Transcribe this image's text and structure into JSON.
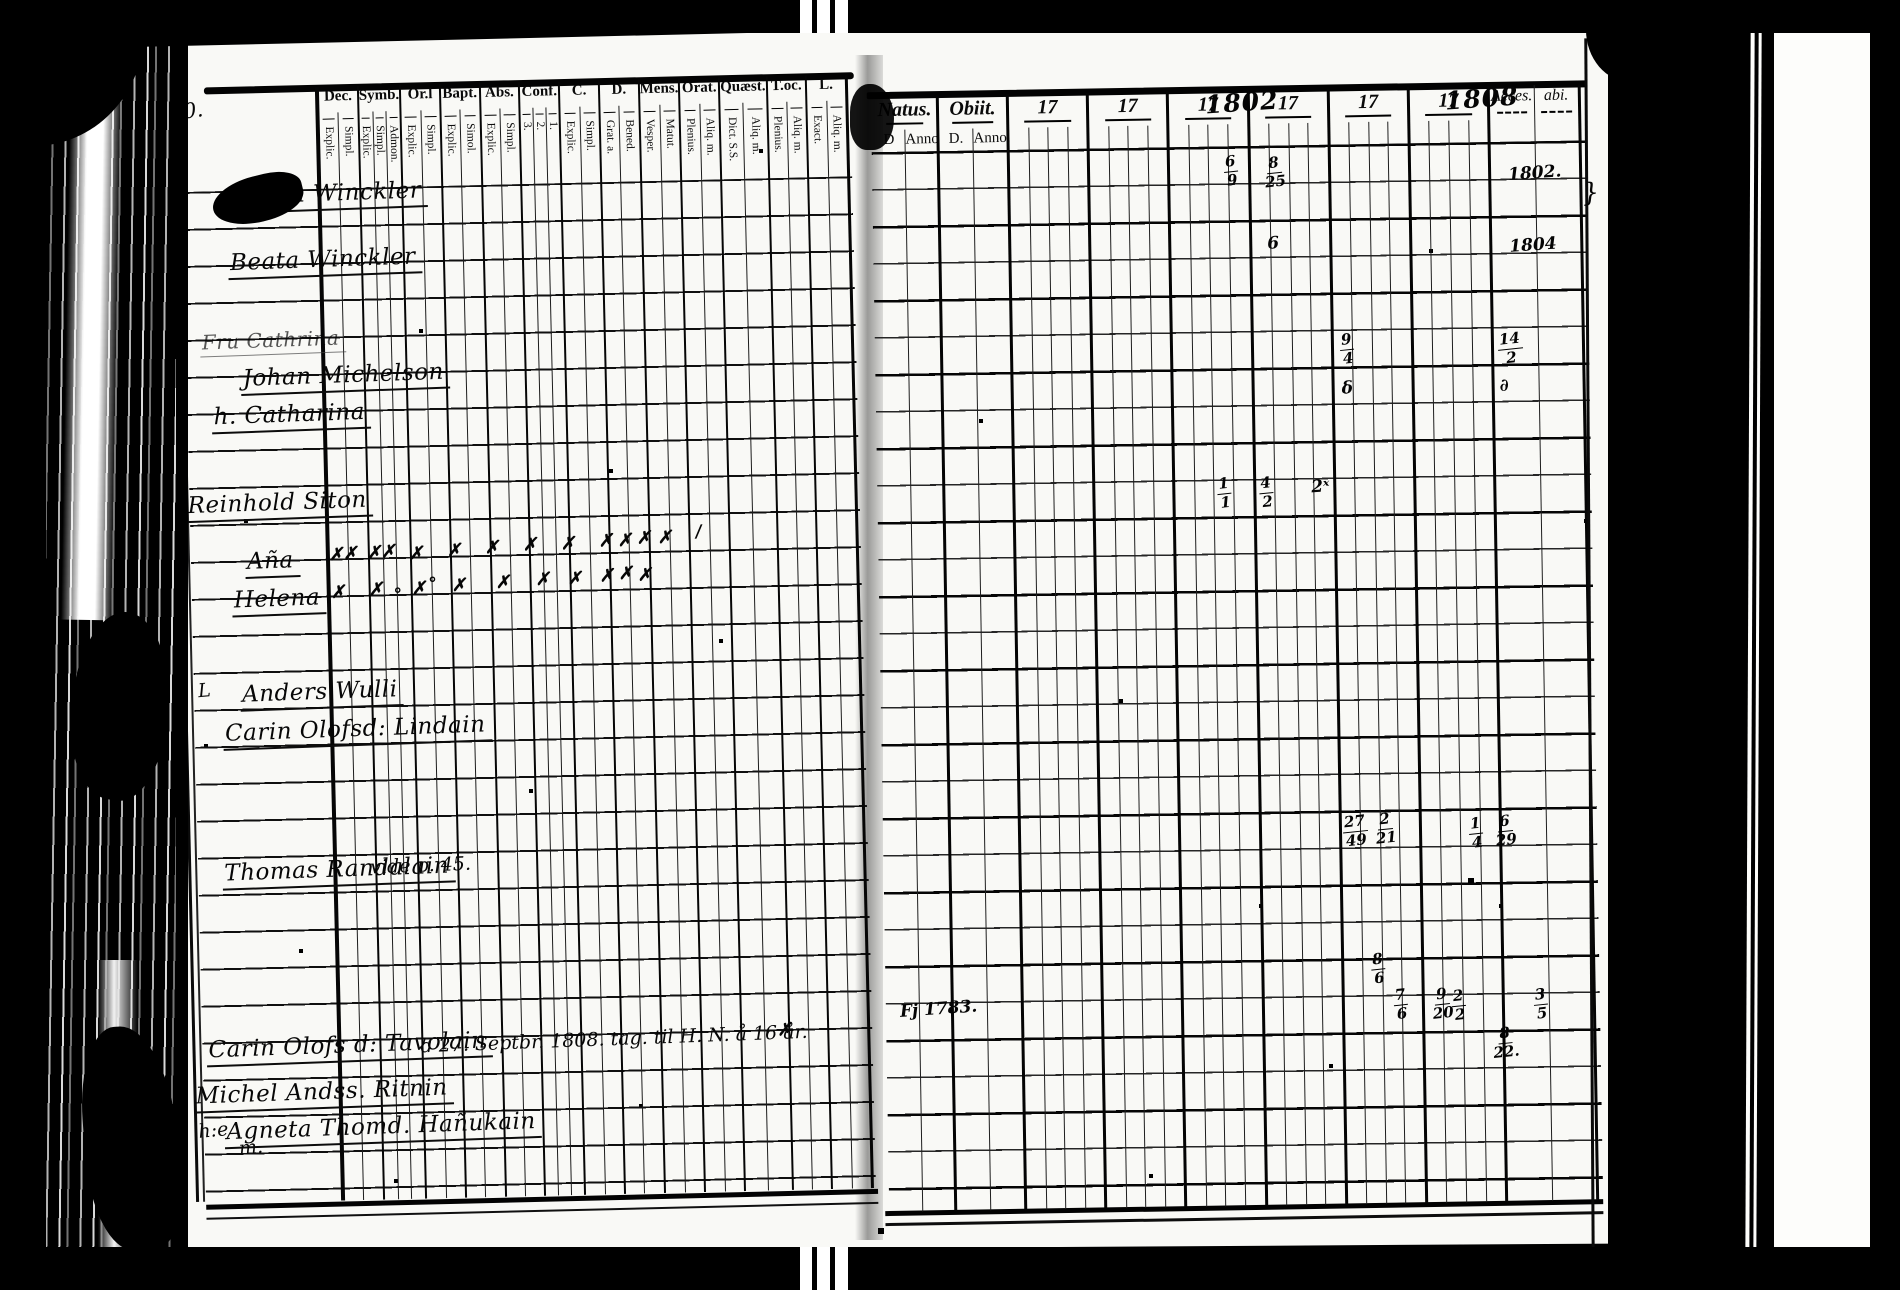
{
  "document": {
    "kind": "scanned parish examination register, two-page spread",
    "left_page_number": "210.",
    "ink_color": "#0a0a0a",
    "paper_color": "#f9f9f6"
  },
  "left_table": {
    "columns": [
      {
        "label": "Dec.",
        "subs": [
          "Explic.",
          "Simpl."
        ]
      },
      {
        "label": "Symb.",
        "subs": [
          "Explic.",
          "Simpl.",
          "Admon."
        ]
      },
      {
        "label": "Or.l",
        "subs": [
          "Explic.",
          "Simpl."
        ]
      },
      {
        "label": "Bapt.",
        "subs": [
          "Explic.",
          "Simol."
        ]
      },
      {
        "label": "Abs.",
        "subs": [
          "Explic.",
          "Simpl."
        ]
      },
      {
        "label": "Conf.",
        "subs": [
          "3.",
          "2.",
          "1."
        ]
      },
      {
        "label": "C.",
        "subs": [
          "Explic.",
          "Simpl."
        ]
      },
      {
        "label": "D.",
        "subs": [
          "Grat. a.",
          "Bened."
        ]
      },
      {
        "label": "Mens.",
        "subs": [
          "Vesper.",
          "Matut."
        ]
      },
      {
        "label": "Orat.",
        "subs": [
          "Plenius.",
          "Aliq. m."
        ]
      },
      {
        "label": "Quæst.",
        "subs": [
          "Dict. S.S.",
          "Aliq. m."
        ]
      },
      {
        "label": "T.oc.",
        "subs": [
          "Plenius.",
          "Aliq. m."
        ]
      },
      {
        "label": "L.",
        "subs": [
          "Exact.",
          "Aliq. m."
        ]
      }
    ],
    "names": [
      {
        "x": 62,
        "y": 140,
        "t": "Johan Winckler"
      },
      {
        "x": 54,
        "y": 206,
        "t": "Beata Winckler"
      },
      {
        "x": 24,
        "y": 286,
        "t": "Fru Cathrina",
        "c": "faint"
      },
      {
        "x": 64,
        "y": 322,
        "t": "Johan Michelson"
      },
      {
        "x": 34,
        "y": 360,
        "t": "h. Catharina"
      },
      {
        "x": 6,
        "y": 448,
        "t": "Reinhold Siton"
      },
      {
        "x": 64,
        "y": 506,
        "t": "Aña"
      },
      {
        "x": 50,
        "y": 544,
        "t": "Helena"
      },
      {
        "x": 56,
        "y": 638,
        "t": "Anders Wulli"
      },
      {
        "x": 38,
        "y": 676,
        "t": "Carin Olofsd: Lindain"
      },
      {
        "x": 34,
        "y": 816,
        "t": "Thomas Randalain"
      },
      {
        "x": 14,
        "y": 992,
        "t": "Carin Olofs d: Tavolain"
      },
      {
        "x": 0,
        "y": 1038,
        "t": "Michel Andss. Ritnin"
      },
      {
        "x": 30,
        "y": 1074,
        "t": "Agneta Thomd. Hañukain"
      }
    ],
    "annotations": [
      {
        "x": -14,
        "y": 56,
        "t": "210.",
        "c": "pagenum"
      },
      {
        "x": -44,
        "y": 212,
        "t": "D:24",
        "c": "pref"
      },
      {
        "x": -26,
        "y": 290,
        "t": "h.",
        "c": "pref"
      },
      {
        "x": -28,
        "y": 450,
        "t": "B:f",
        "c": "pref"
      },
      {
        "x": 14,
        "y": 636,
        "t": "L",
        "c": "pref"
      },
      {
        "x": -48,
        "y": 1040,
        "t": "Gml",
        "c": "pref"
      },
      {
        "x": 4,
        "y": 1076,
        "t": "h:e",
        "c": "pref"
      },
      {
        "x": 182,
        "y": 816,
        "t": "vide p. 45.",
        "c": "note"
      },
      {
        "x": 228,
        "y": 994,
        "t": "d 27. Septbr. 1808. tag. til H. N. å 16 år.",
        "c": "note"
      },
      {
        "x": 44,
        "y": 1094,
        "t": "m.",
        "c": "pref"
      }
    ],
    "attendance_marks": [
      {
        "x": 148,
        "y": 504,
        "t": "✗✗"
      },
      {
        "x": 186,
        "y": 503,
        "t": "✗✗"
      },
      {
        "x": 228,
        "y": 505,
        "t": "✗"
      },
      {
        "x": 266,
        "y": 503,
        "t": "✗"
      },
      {
        "x": 304,
        "y": 501,
        "t": "✗"
      },
      {
        "x": 342,
        "y": 499,
        "t": "✗"
      },
      {
        "x": 380,
        "y": 499,
        "t": "✗"
      },
      {
        "x": 418,
        "y": 497,
        "t": "✗"
      },
      {
        "x": 437,
        "y": 497,
        "t": "✗"
      },
      {
        "x": 456,
        "y": 495,
        "t": "✗"
      },
      {
        "x": 477,
        "y": 495,
        "t": "✗"
      },
      {
        "x": 515,
        "y": 490,
        "t": "∕"
      },
      {
        "x": 149,
        "y": 542,
        "t": "✗"
      },
      {
        "x": 187,
        "y": 540,
        "t": "✗"
      },
      {
        "x": 212,
        "y": 546,
        "t": "°"
      },
      {
        "x": 230,
        "y": 540,
        "t": "✗"
      },
      {
        "x": 247,
        "y": 536,
        "t": "°"
      },
      {
        "x": 270,
        "y": 538,
        "t": "✗"
      },
      {
        "x": 314,
        "y": 536,
        "t": "✗"
      },
      {
        "x": 354,
        "y": 534,
        "t": "✗"
      },
      {
        "x": 386,
        "y": 534,
        "t": "✗"
      },
      {
        "x": 418,
        "y": 532,
        "t": "✗"
      },
      {
        "x": 437,
        "y": 530,
        "t": "✗"
      },
      {
        "x": 456,
        "y": 532,
        "t": "✗"
      },
      {
        "x": 585,
        "y": 990,
        "t": "✗"
      }
    ]
  },
  "right_table": {
    "natus_label": "Natus.",
    "natus_subs": [
      "D",
      "Anno"
    ],
    "obiit_label": "Obiit.",
    "obiit_subs": [
      "D.",
      "Anno."
    ],
    "year_columns": [
      {
        "printed": "17",
        "hw": ""
      },
      {
        "printed": "17",
        "hw": ""
      },
      {
        "printed": "17",
        "hw": "1802"
      },
      {
        "printed": "17",
        "hw": ""
      },
      {
        "printed": "17",
        "hw": ""
      },
      {
        "printed": "17",
        "hw": "1808"
      }
    ],
    "acces_label": "Acces.",
    "abi_label": "abi.",
    "fraction_marks": [
      {
        "x": 356,
        "y": 104,
        "top": "6",
        "bot": "9"
      },
      {
        "x": 396,
        "y": 106,
        "top": "8",
        "bot": "25"
      },
      {
        "x": 469,
        "y": 284,
        "top": "9",
        "bot": "4"
      },
      {
        "x": 627,
        "y": 286,
        "top": "14",
        "bot": "2"
      },
      {
        "x": 344,
        "y": 426,
        "top": "1",
        "bot": "1"
      },
      {
        "x": 386,
        "y": 426,
        "top": "4",
        "bot": "2"
      },
      {
        "x": 464,
        "y": 766,
        "top": "27",
        "bot": "49"
      },
      {
        "x": 496,
        "y": 764,
        "top": "2",
        "bot": "21"
      },
      {
        "x": 590,
        "y": 770,
        "top": "1",
        "bot": "4"
      },
      {
        "x": 616,
        "y": 768,
        "top": "6",
        "bot": "29"
      },
      {
        "x": 490,
        "y": 904,
        "top": "8",
        "bot": "6"
      },
      {
        "x": 512,
        "y": 940,
        "top": "7",
        "bot": "6"
      },
      {
        "x": 550,
        "y": 940,
        "top": "9",
        "bot": "20"
      },
      {
        "x": 570,
        "y": 942,
        "top": "2",
        "bot": "2"
      },
      {
        "x": 652,
        "y": 942,
        "top": "3",
        "bot": "5"
      },
      {
        "x": 610,
        "y": 980,
        "top": "8",
        "bot": "22."
      }
    ],
    "text_marks": [
      {
        "x": 640,
        "y": 118,
        "t": "1802."
      },
      {
        "x": 640,
        "y": 190,
        "t": "1804"
      },
      {
        "x": 398,
        "y": 184,
        "t": "6"
      },
      {
        "x": 470,
        "y": 330,
        "t": "δ"
      },
      {
        "x": 628,
        "y": 330,
        "t": "∂"
      },
      {
        "x": 438,
        "y": 428,
        "t": "2ˣ"
      },
      {
        "x": 18,
        "y": 944,
        "t": "Fj 1783."
      },
      {
        "x": 714,
        "y": 134,
        "t": "}",
        "c": "big"
      }
    ]
  }
}
